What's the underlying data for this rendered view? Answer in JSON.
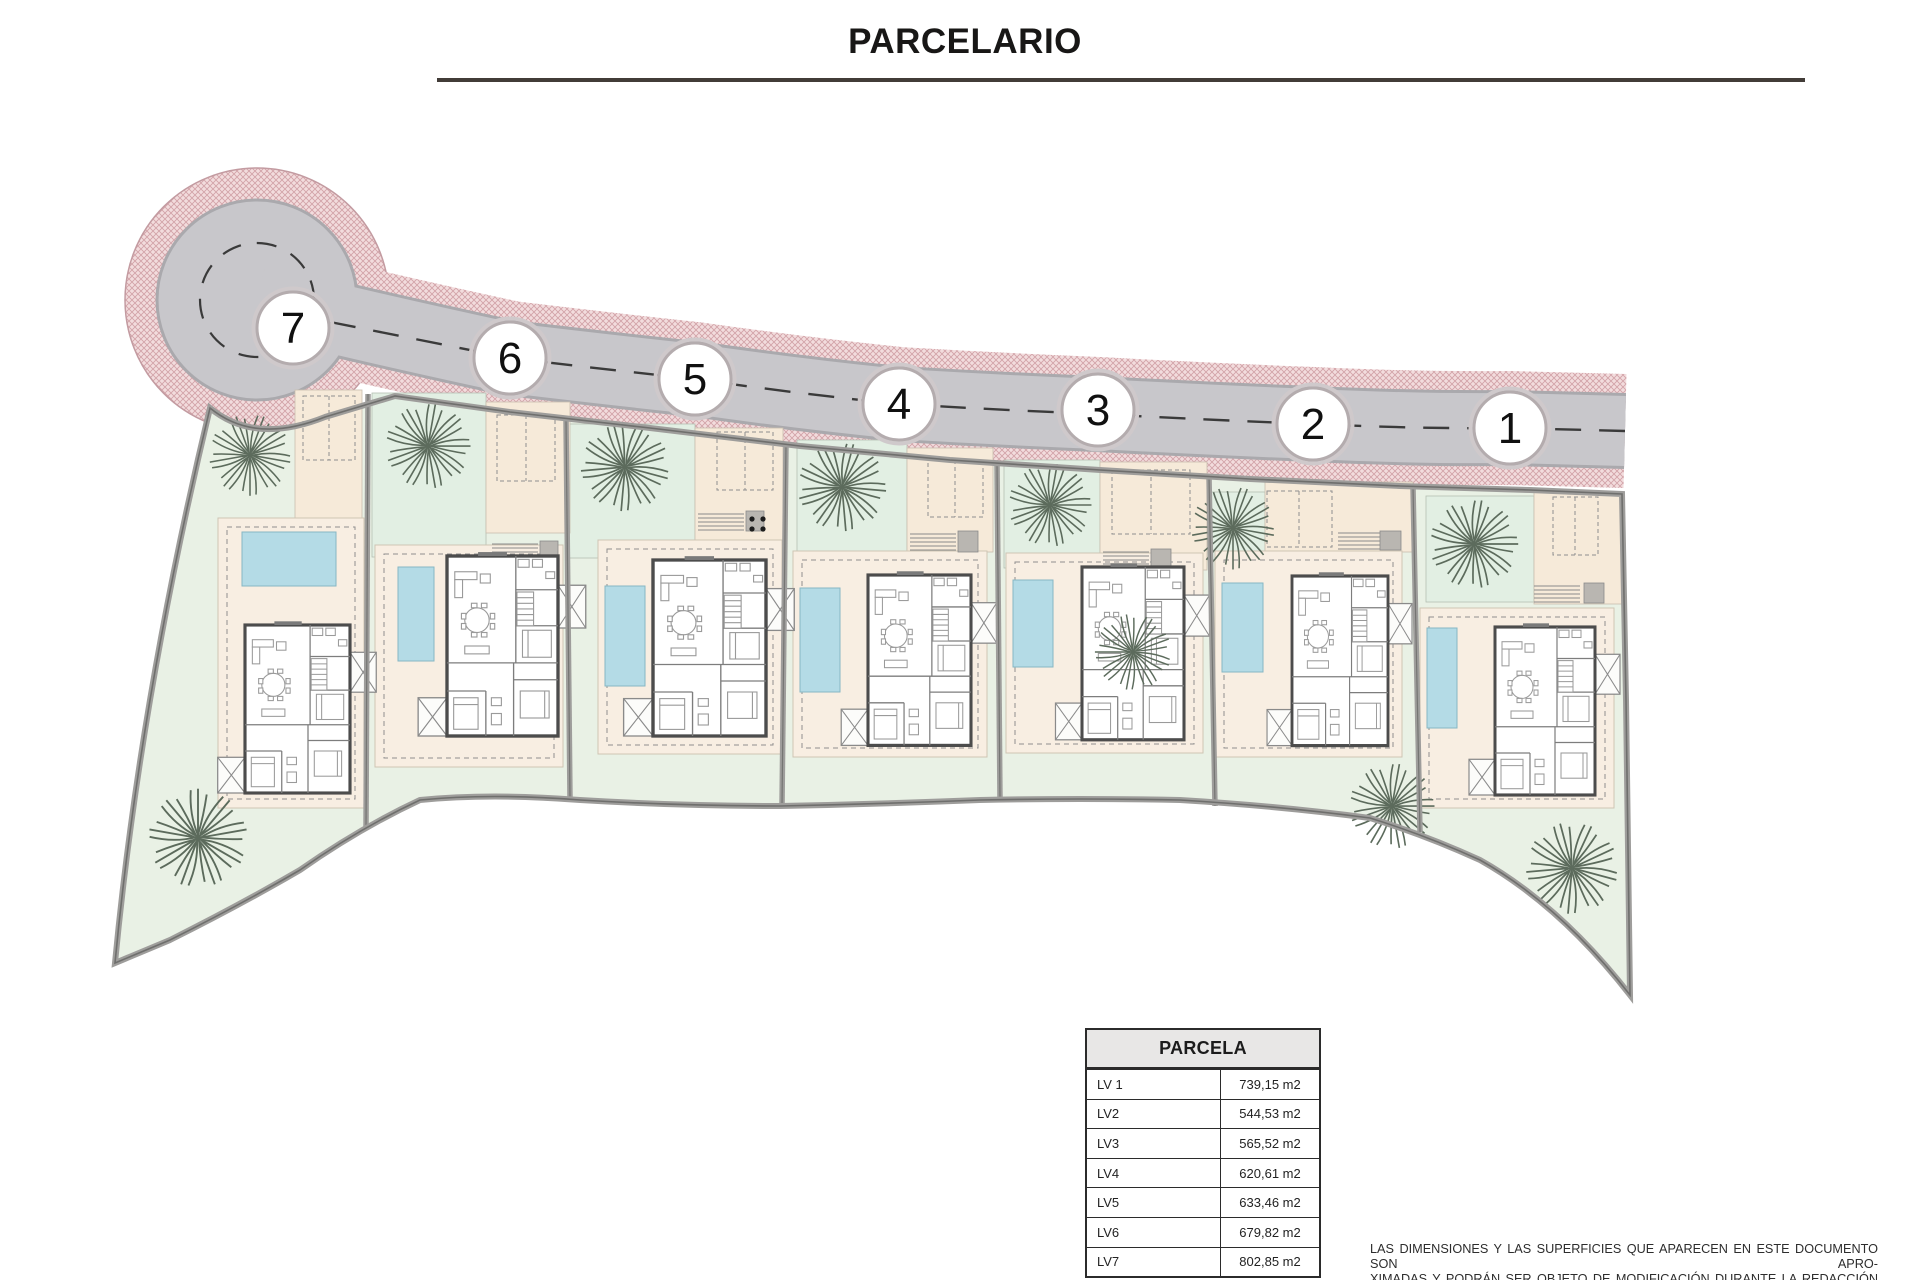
{
  "title": "PARCELARIO",
  "plan": {
    "markers": [
      {
        "label": "7"
      },
      {
        "label": "6"
      },
      {
        "label": "5"
      },
      {
        "label": "4"
      },
      {
        "label": "3"
      },
      {
        "label": "2"
      },
      {
        "label": "1"
      }
    ],
    "colors": {
      "sidewalk_pink": "#f2dcdd",
      "sidewalk_hatch": "#d2a3a8",
      "road_gray": "#c8c7cb",
      "garden_green": "#e9f1e5",
      "terrace_cream": "#f8eee2",
      "pool_blue": "#b4dbe6"
    }
  },
  "table": {
    "header": "PARCELA",
    "rows": [
      {
        "label": "LV 1",
        "value": "739,15 m2"
      },
      {
        "label": "LV2",
        "value": "544,53 m2"
      },
      {
        "label": "LV3",
        "value": "565,52 m2"
      },
      {
        "label": "LV4",
        "value": "620,61 m2"
      },
      {
        "label": "LV5",
        "value": "633,46 m2"
      },
      {
        "label": "LV6",
        "value": "679,82 m2"
      },
      {
        "label": "LV7",
        "value": "802,85 m2"
      }
    ]
  },
  "disclaimer": {
    "line1": "LAS DIMENSIONES Y LAS SUPERFICIES QUE APARECEN EN ESTE DOCUMENTO SON APRO-",
    "line2": "XIMADAS Y PODRÁN SER OBJETO DE MODIFICACIÓN DURANTE LA REDACCIÓN DE LOS",
    "line3": "PROYECTOS BÁSICO Y DE EJECUCIÓN."
  }
}
